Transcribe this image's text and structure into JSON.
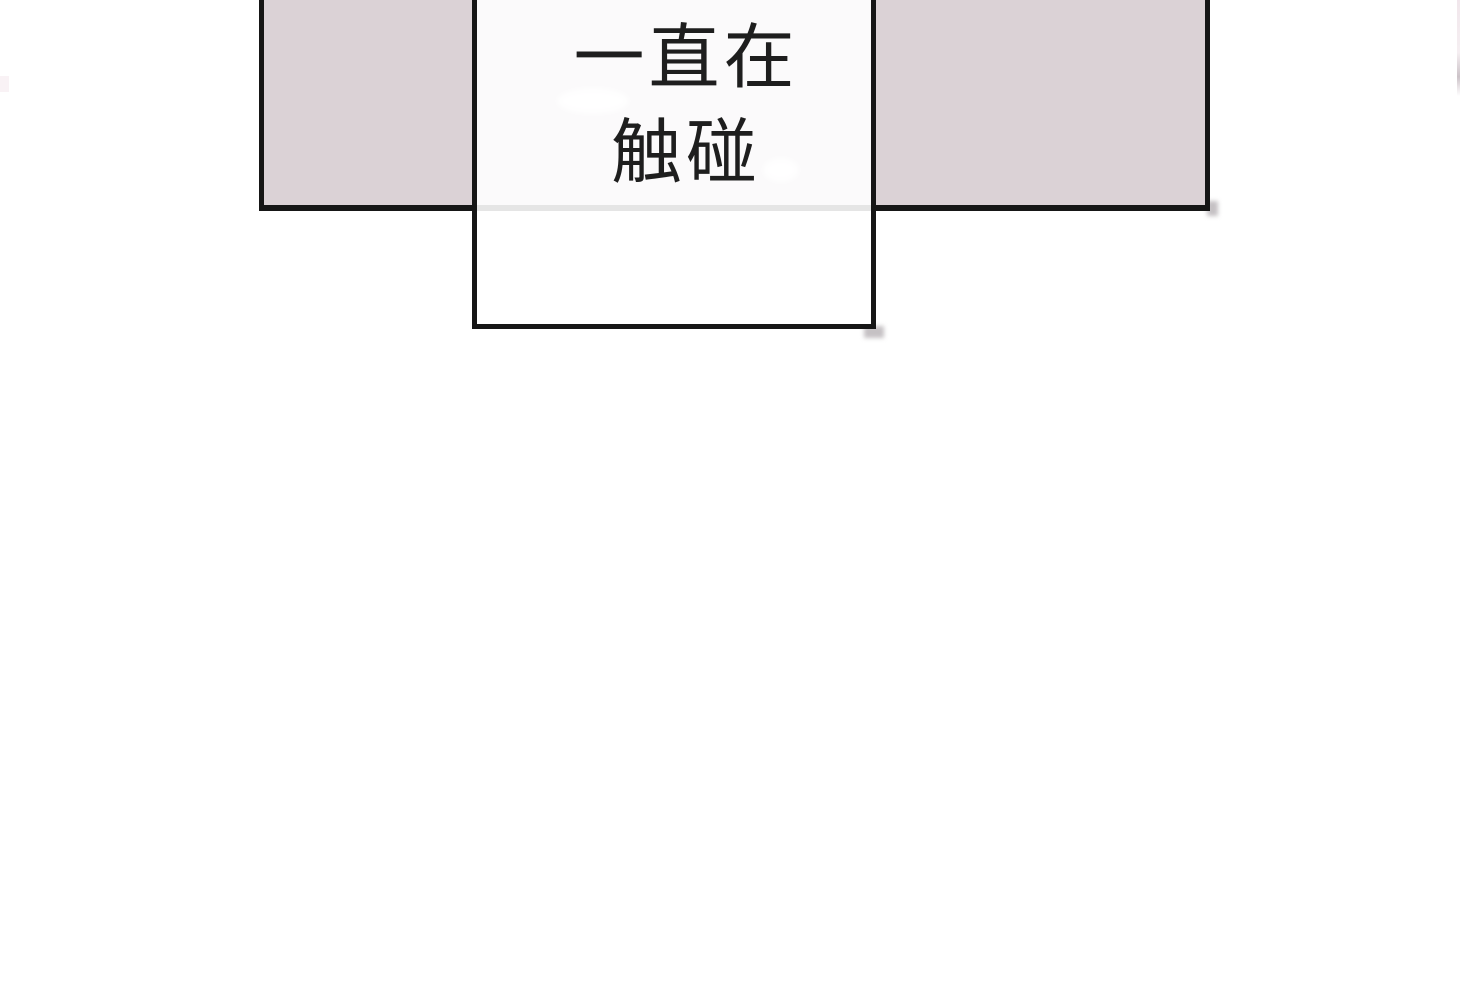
{
  "comic": {
    "speech_bubble": {
      "lines": [
        "一直在",
        "触碰"
      ],
      "text": "一直在触碰"
    }
  },
  "colors": {
    "page-bg": "#ffffff",
    "panel-fill": "#dbd2d6",
    "line-ink": "#161616",
    "bubble-fill": "rgba(255,255,255,0.89)",
    "text-ink": "#1e1e1e"
  }
}
